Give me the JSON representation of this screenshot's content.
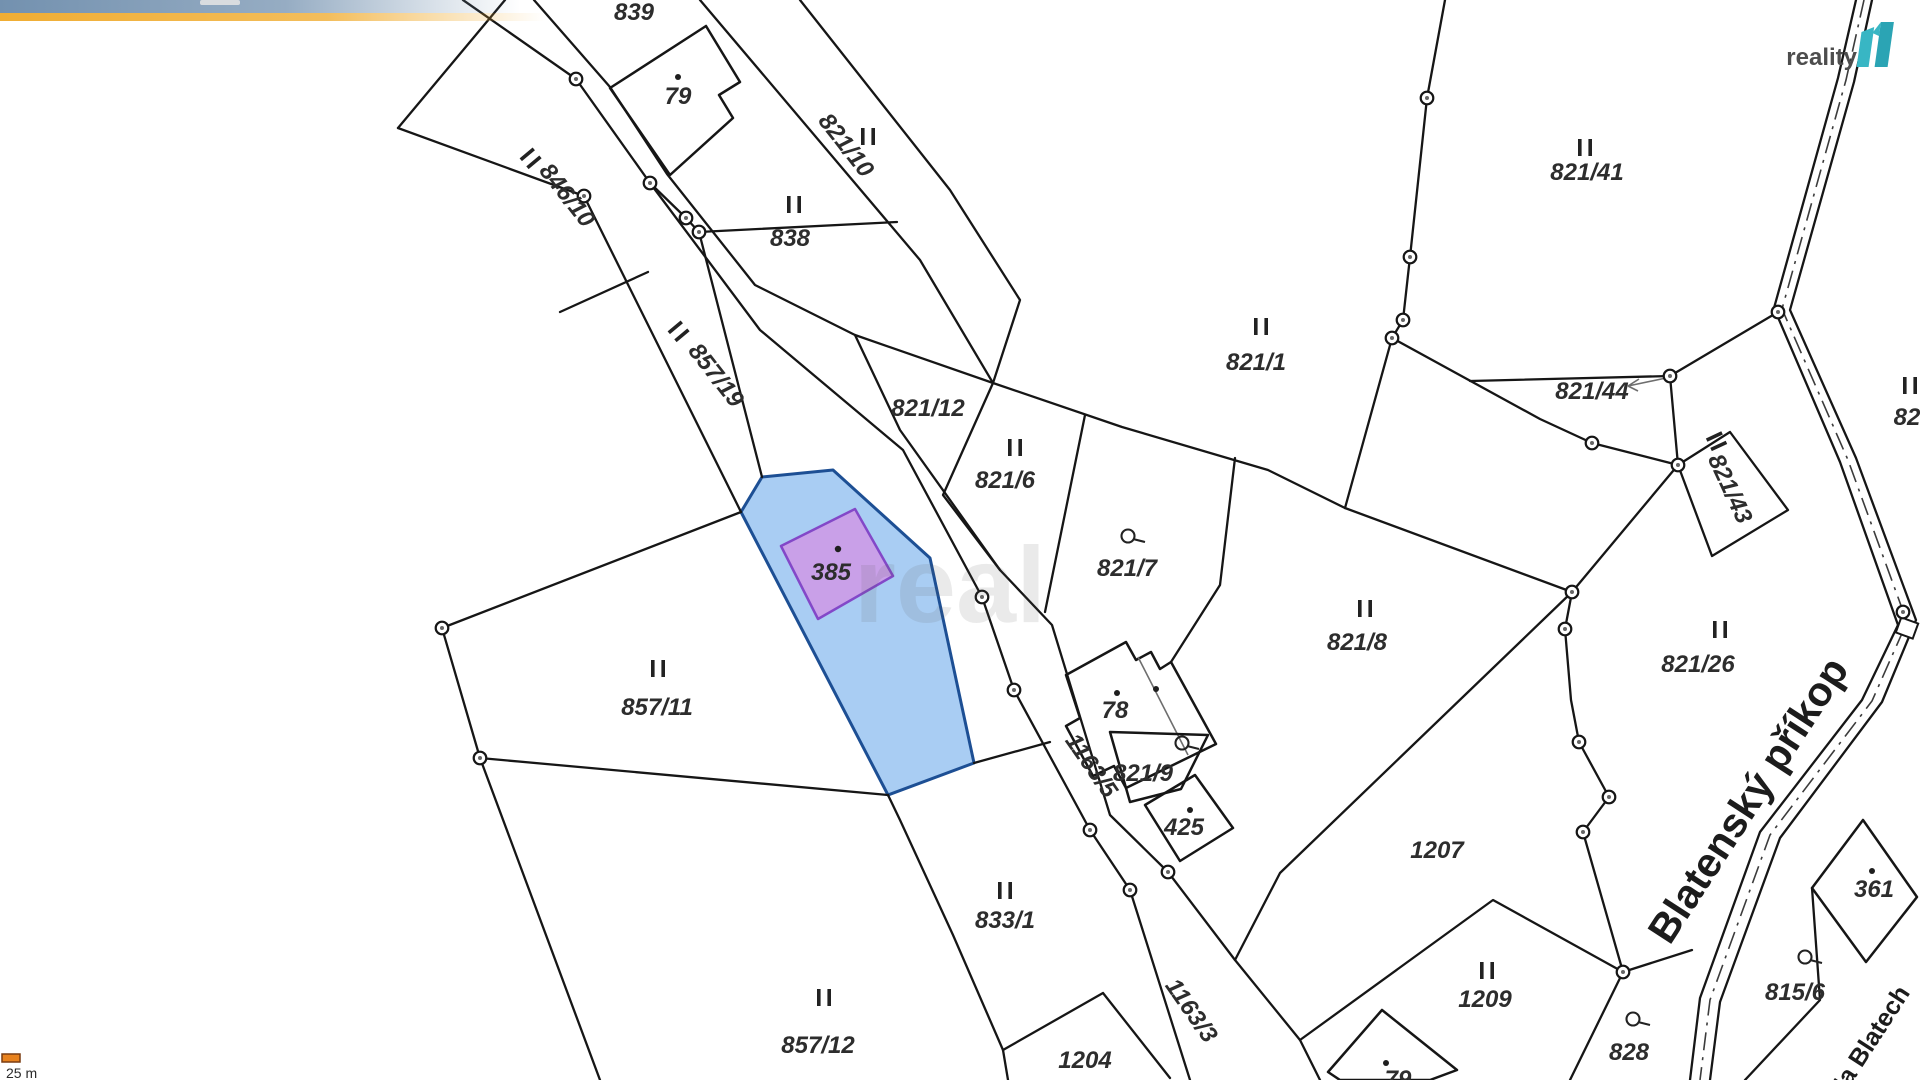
{
  "branding": {
    "logo_text": "reality",
    "logo_mark": "11",
    "logo_color": "#38b6c4",
    "logo_color_dark": "#2ba4b4",
    "watermark": "real"
  },
  "scale_bar": {
    "label": "25 m",
    "bar_color": "#e8821e",
    "bar_border": "#7a3c10"
  },
  "decor": {
    "stripe_blue": "#7391af",
    "stripe_yellow": "#f0ad33"
  },
  "map": {
    "background": "#ffffff",
    "line_color": "#161616",
    "highlight": {
      "parcel_fill": "#a9cdf3",
      "parcel_stroke": "#1d4f94",
      "building_fill": "#c9a0e8",
      "building_stroke": "#8348c8"
    },
    "symbols": {
      "land_use": "II",
      "no_build_circle": "circle-with-tail",
      "vertex": "ring-dot"
    },
    "labels": [
      {
        "text": "839",
        "kind": "parcel"
      },
      {
        "text": "79",
        "kind": "building"
      },
      {
        "text": "821/10",
        "kind": "parcel"
      },
      {
        "text": "838",
        "kind": "parcel"
      },
      {
        "text": "846/10",
        "kind": "parcel"
      },
      {
        "text": "857/19",
        "kind": "parcel"
      },
      {
        "text": "821/12",
        "kind": "parcel"
      },
      {
        "text": "821/6",
        "kind": "parcel"
      },
      {
        "text": "821/7",
        "kind": "parcel"
      },
      {
        "text": "821/1",
        "kind": "parcel"
      },
      {
        "text": "821/41",
        "kind": "parcel"
      },
      {
        "text": "821/44",
        "kind": "parcel"
      },
      {
        "text": "821/43",
        "kind": "parcel"
      },
      {
        "text": "82",
        "kind": "parcel-cut"
      },
      {
        "text": "821/8",
        "kind": "parcel"
      },
      {
        "text": "821/26",
        "kind": "parcel"
      },
      {
        "text": "1207",
        "kind": "parcel"
      },
      {
        "text": "78",
        "kind": "building"
      },
      {
        "text": "821/9",
        "kind": "parcel"
      },
      {
        "text": "425",
        "kind": "building"
      },
      {
        "text": "1163/5",
        "kind": "road"
      },
      {
        "text": "833/1",
        "kind": "parcel"
      },
      {
        "text": "857/11",
        "kind": "parcel"
      },
      {
        "text": "857/12",
        "kind": "parcel"
      },
      {
        "text": "1204",
        "kind": "parcel"
      },
      {
        "text": "1163/3",
        "kind": "road"
      },
      {
        "text": "1209",
        "kind": "parcel"
      },
      {
        "text": "828",
        "kind": "parcel"
      },
      {
        "text": "815/6",
        "kind": "parcel"
      },
      {
        "text": "361",
        "kind": "building"
      },
      {
        "text": "79",
        "kind": "building-cut"
      },
      {
        "text": "385",
        "kind": "highlighted-building"
      },
      {
        "text": "Blatenský příkop",
        "kind": "street"
      },
      {
        "text": "Na Blatech",
        "kind": "street"
      }
    ]
  }
}
